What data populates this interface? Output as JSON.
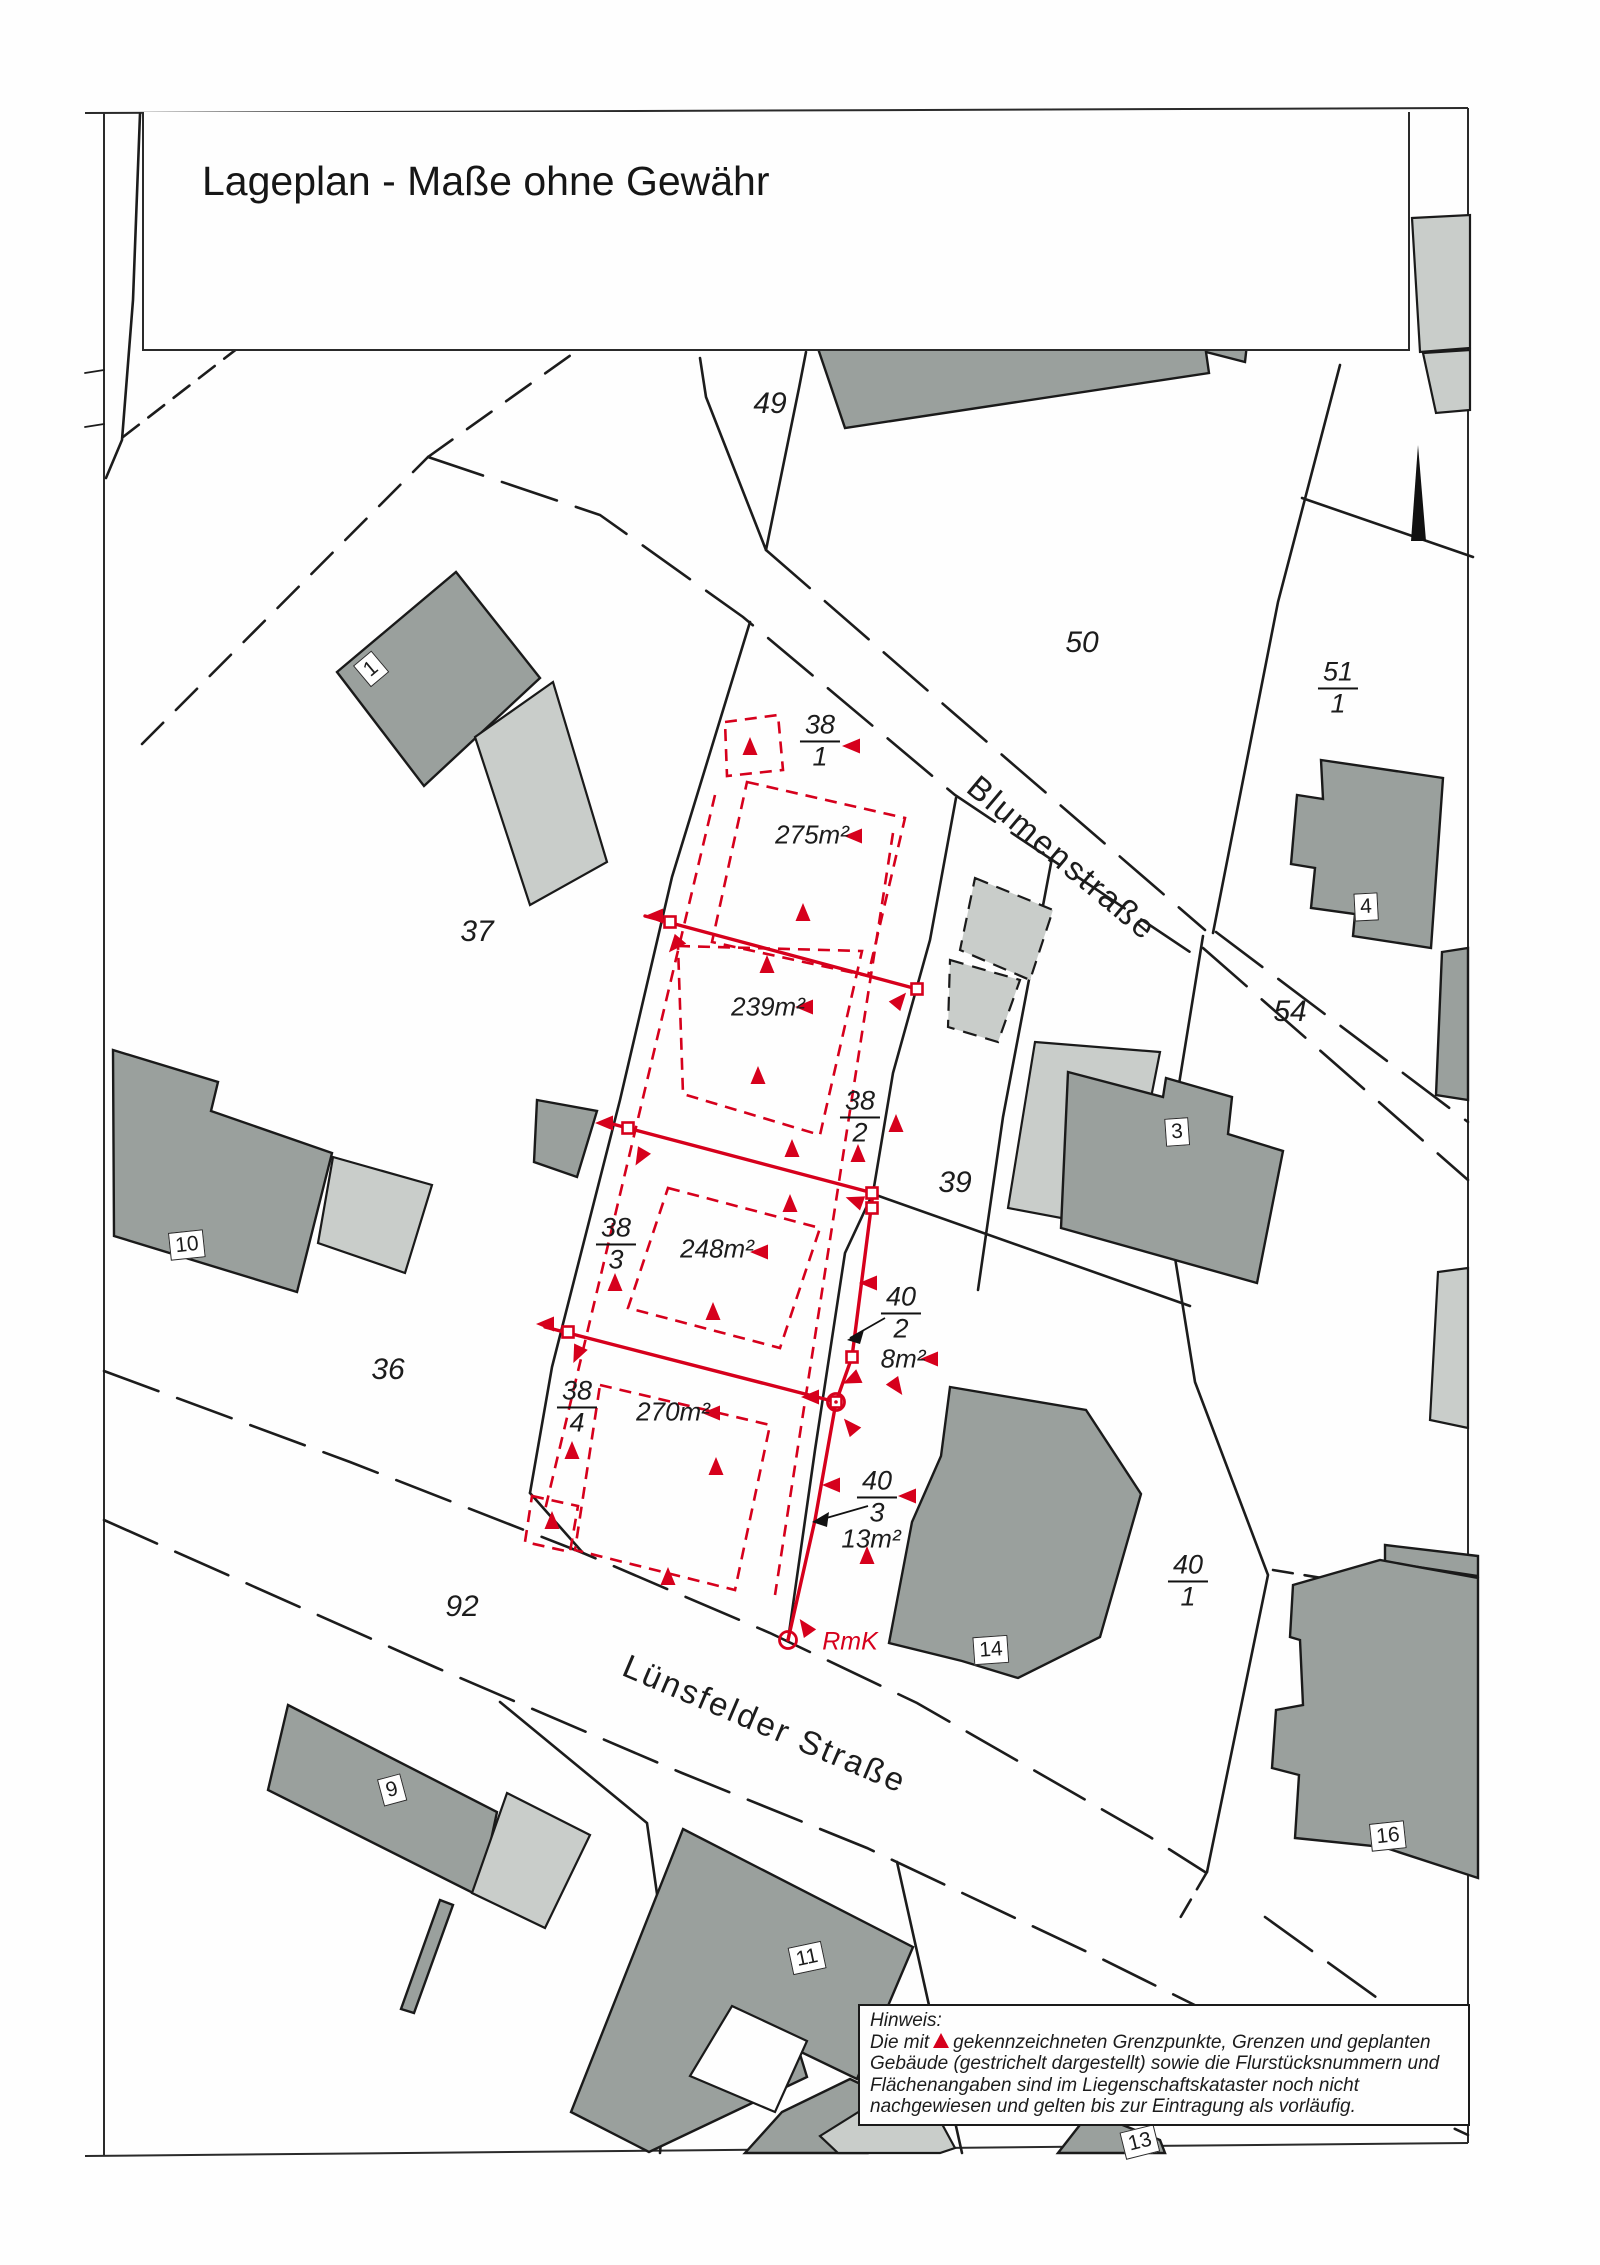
{
  "page": {
    "title": "Lageplan - Maße ohne Gewähr"
  },
  "colors": {
    "red": "#d6001c",
    "building_dark": "#9aa09d",
    "building_light": "#c9cdca",
    "line": "#1c1c1c",
    "paper": "#fefefe"
  },
  "streets": [
    {
      "name": "Blumenstraße",
      "x": 1062,
      "y": 858,
      "rot": 40
    },
    {
      "name": "Lünsfelder Straße",
      "x": 765,
      "y": 1724,
      "rot": 23
    }
  ],
  "parcel_numbers": [
    {
      "text": "49",
      "x": 770,
      "y": 404
    },
    {
      "text": "50",
      "x": 1082,
      "y": 643
    },
    {
      "text": "37",
      "x": 477,
      "y": 932
    },
    {
      "text": "54",
      "x": 1290,
      "y": 1012
    },
    {
      "text": "39",
      "x": 955,
      "y": 1183
    },
    {
      "text": "36",
      "x": 388,
      "y": 1370
    },
    {
      "text": "92",
      "x": 462,
      "y": 1607
    }
  ],
  "parcel_fractions": [
    {
      "num": "51",
      "den": "1",
      "x": 1338,
      "y": 688
    },
    {
      "num": "38",
      "den": "1",
      "x": 820,
      "y": 741
    },
    {
      "num": "38",
      "den": "2",
      "x": 860,
      "y": 1117
    },
    {
      "num": "38",
      "den": "3",
      "x": 616,
      "y": 1244
    },
    {
      "num": "38",
      "den": "4",
      "x": 577,
      "y": 1407
    },
    {
      "num": "40",
      "den": "2",
      "x": 901,
      "y": 1313
    },
    {
      "num": "40",
      "den": "3",
      "x": 877,
      "y": 1497
    },
    {
      "num": "40",
      "den": "1",
      "x": 1188,
      "y": 1581
    }
  ],
  "area_labels": [
    {
      "text": "275m²",
      "x": 812,
      "y": 835
    },
    {
      "text": "239m²",
      "x": 768,
      "y": 1007
    },
    {
      "text": "248m²",
      "x": 717,
      "y": 1249
    },
    {
      "text": "270m²",
      "x": 673,
      "y": 1412
    },
    {
      "text": "8m²",
      "x": 903,
      "y": 1359
    },
    {
      "text": "13m²",
      "x": 871,
      "y": 1539
    }
  ],
  "house_numbers": [
    {
      "text": "1",
      "x": 371,
      "y": 669,
      "rot": -40
    },
    {
      "text": "10",
      "x": 187,
      "y": 1245,
      "rot": -6
    },
    {
      "text": "3",
      "x": 1177,
      "y": 1132,
      "rot": -4
    },
    {
      "text": "4",
      "x": 1366,
      "y": 907,
      "rot": -3
    },
    {
      "text": "9",
      "x": 392,
      "y": 1790,
      "rot": -15
    },
    {
      "text": "14",
      "x": 991,
      "y": 1650,
      "rot": -4
    },
    {
      "text": "11",
      "x": 807,
      "y": 1958,
      "rot": -12
    },
    {
      "text": "16",
      "x": 1388,
      "y": 1836,
      "rot": -6
    },
    {
      "text": "13",
      "x": 1140,
      "y": 2142,
      "rot": -14
    }
  ],
  "rmk_label": {
    "text": "RmK",
    "x": 850,
    "y": 1642
  },
  "hinweis": {
    "title": "Hinweis:",
    "line1_pre": "Die mit",
    "line1_post": "gekennzeichneten Grenzpunkte, Grenzen und geplanten",
    "line2": "Gebäude (gestrichelt dargestellt) sowie die Flurstücksnummern und",
    "line3": "Flächenangaben sind im Liegenschaftskataster noch nicht",
    "line4": "nachgewiesen und gelten bis zur Eintragung als vorläufig."
  },
  "boundary_point_symbols": [
    {
      "x": 750,
      "y": 748,
      "r": 0
    },
    {
      "x": 853,
      "y": 746,
      "r": -90
    },
    {
      "x": 855,
      "y": 836,
      "r": -90
    },
    {
      "x": 803,
      "y": 914,
      "r": 0
    },
    {
      "x": 656,
      "y": 916,
      "r": -90
    },
    {
      "x": 676,
      "y": 944,
      "r": -140
    },
    {
      "x": 899,
      "y": 1001,
      "r": 40
    },
    {
      "x": 806,
      "y": 1007,
      "r": -90
    },
    {
      "x": 767,
      "y": 966,
      "r": 0
    },
    {
      "x": 758,
      "y": 1077,
      "r": 0
    },
    {
      "x": 896,
      "y": 1125,
      "r": 0
    },
    {
      "x": 858,
      "y": 1155,
      "r": 0
    },
    {
      "x": 792,
      "y": 1150,
      "r": 0
    },
    {
      "x": 606,
      "y": 1123,
      "r": -90
    },
    {
      "x": 641,
      "y": 1156,
      "r": -150
    },
    {
      "x": 856,
      "y": 1201,
      "r": -70
    },
    {
      "x": 761,
      "y": 1252,
      "r": -90
    },
    {
      "x": 790,
      "y": 1205,
      "r": 0
    },
    {
      "x": 615,
      "y": 1284,
      "r": 0
    },
    {
      "x": 713,
      "y": 1313,
      "r": 0
    },
    {
      "x": 547,
      "y": 1324,
      "r": -90
    },
    {
      "x": 578,
      "y": 1353,
      "r": -155
    },
    {
      "x": 812,
      "y": 1397,
      "r": -90
    },
    {
      "x": 851,
      "y": 1427,
      "r": -40
    },
    {
      "x": 853,
      "y": 1379,
      "r": -115
    },
    {
      "x": 713,
      "y": 1413,
      "r": -90
    },
    {
      "x": 716,
      "y": 1468,
      "r": 0
    },
    {
      "x": 572,
      "y": 1452,
      "r": 0
    },
    {
      "x": 668,
      "y": 1578,
      "r": 0
    },
    {
      "x": 552,
      "y": 1522,
      "r": 0
    },
    {
      "x": 870,
      "y": 1283,
      "r": -90
    },
    {
      "x": 931,
      "y": 1359,
      "r": -90
    },
    {
      "x": 896,
      "y": 1386,
      "r": 145
    },
    {
      "x": 833,
      "y": 1485,
      "r": -90
    },
    {
      "x": 909,
      "y": 1496,
      "r": -90
    },
    {
      "x": 867,
      "y": 1557,
      "r": 0
    },
    {
      "x": 806,
      "y": 1628,
      "r": -35
    }
  ],
  "boundary_markers": {
    "squares": [
      {
        "x": 670,
        "y": 922
      },
      {
        "x": 917,
        "y": 989
      },
      {
        "x": 628,
        "y": 1128
      },
      {
        "x": 872,
        "y": 1193
      },
      {
        "x": 872,
        "y": 1208
      },
      {
        "x": 568,
        "y": 1332
      },
      {
        "x": 852,
        "y": 1357
      },
      {
        "x": 836,
        "y": 1402
      }
    ],
    "circles": [
      {
        "x": 836,
        "y": 1402
      },
      {
        "x": 788,
        "y": 1640
      }
    ]
  }
}
